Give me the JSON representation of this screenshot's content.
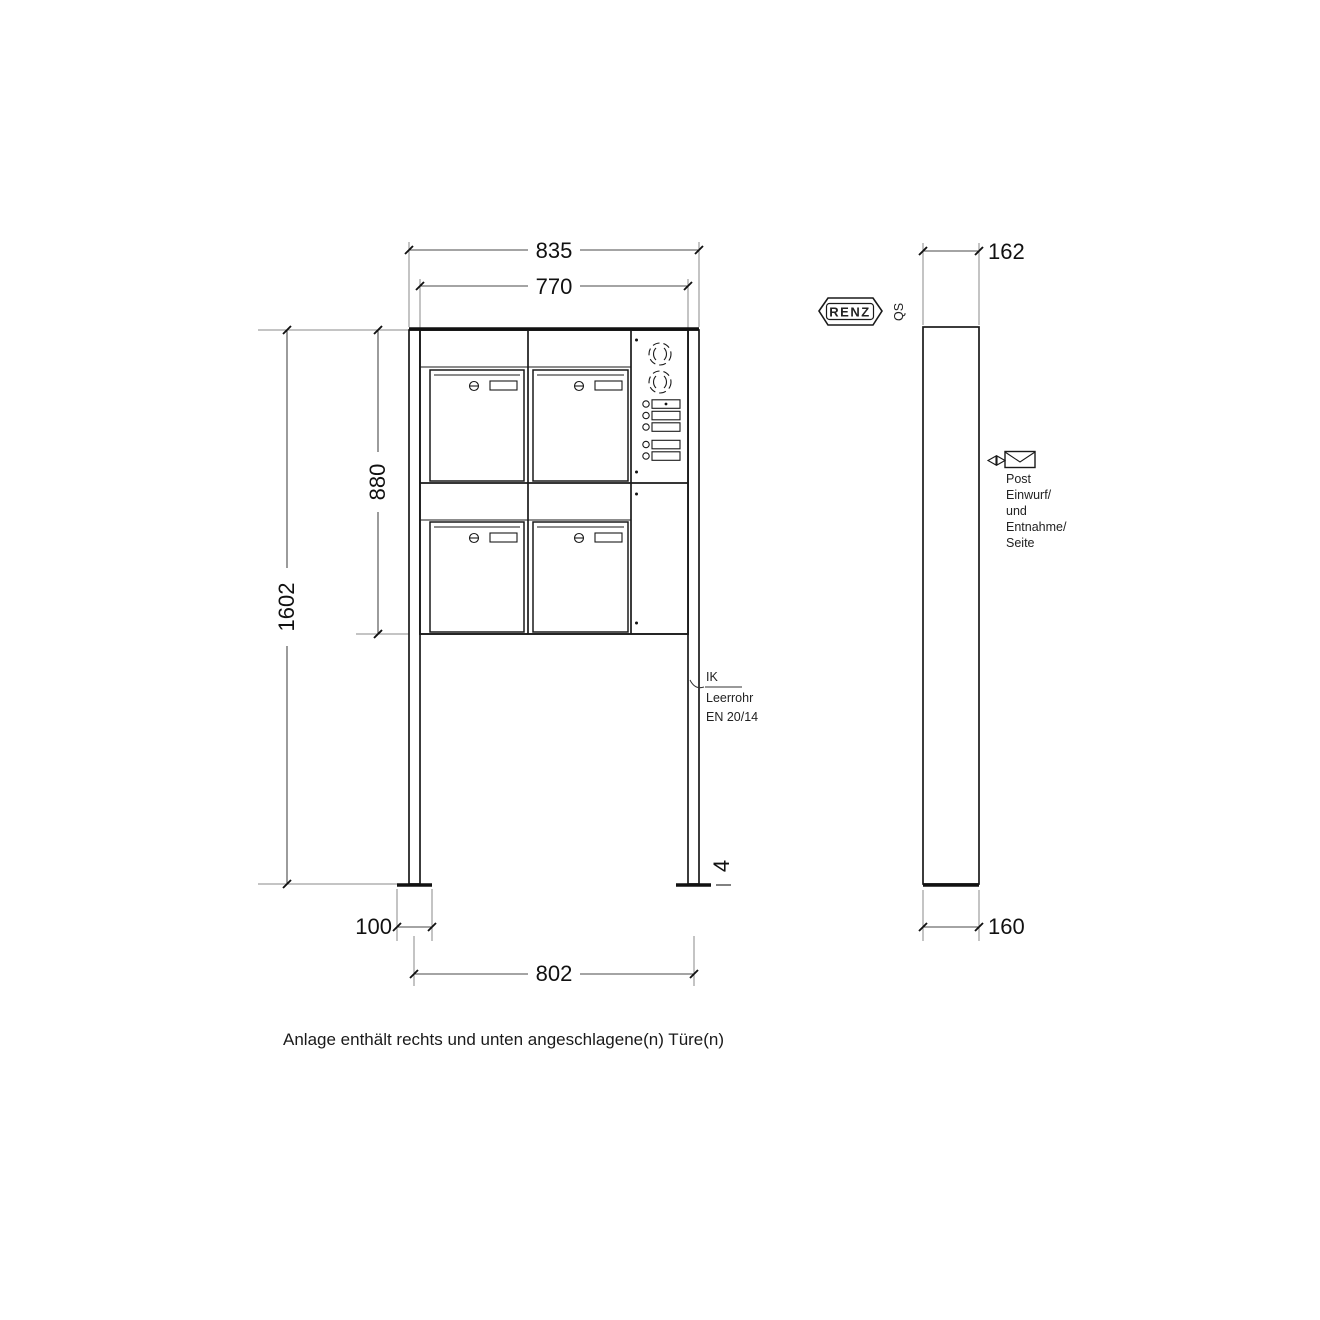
{
  "drawing": {
    "caption": "Anlage enthält rechts und unten angeschlagene(n) Türe(n)",
    "brand": {
      "name": "RENZ",
      "qs": "QS"
    },
    "front": {
      "dim_total_width": "835",
      "dim_body_width": "770",
      "dim_body_height": "880",
      "dim_total_height": "1602",
      "dim_foot_width": "100",
      "dim_anchor_spacing": "802",
      "dim_base_gap": "4",
      "leader": {
        "l1": "IK",
        "l2": "Leerrohr",
        "l3": "EN 20/14"
      }
    },
    "side": {
      "dim_depth": "162",
      "dim_foot_depth": "160",
      "note": [
        "Post",
        "Einwurf/",
        "und",
        "Entnahme/",
        "Seite"
      ]
    },
    "colors": {
      "line": "#1a1a1a",
      "extension_line": "#8a8a8a",
      "background": "#ffffff"
    }
  }
}
